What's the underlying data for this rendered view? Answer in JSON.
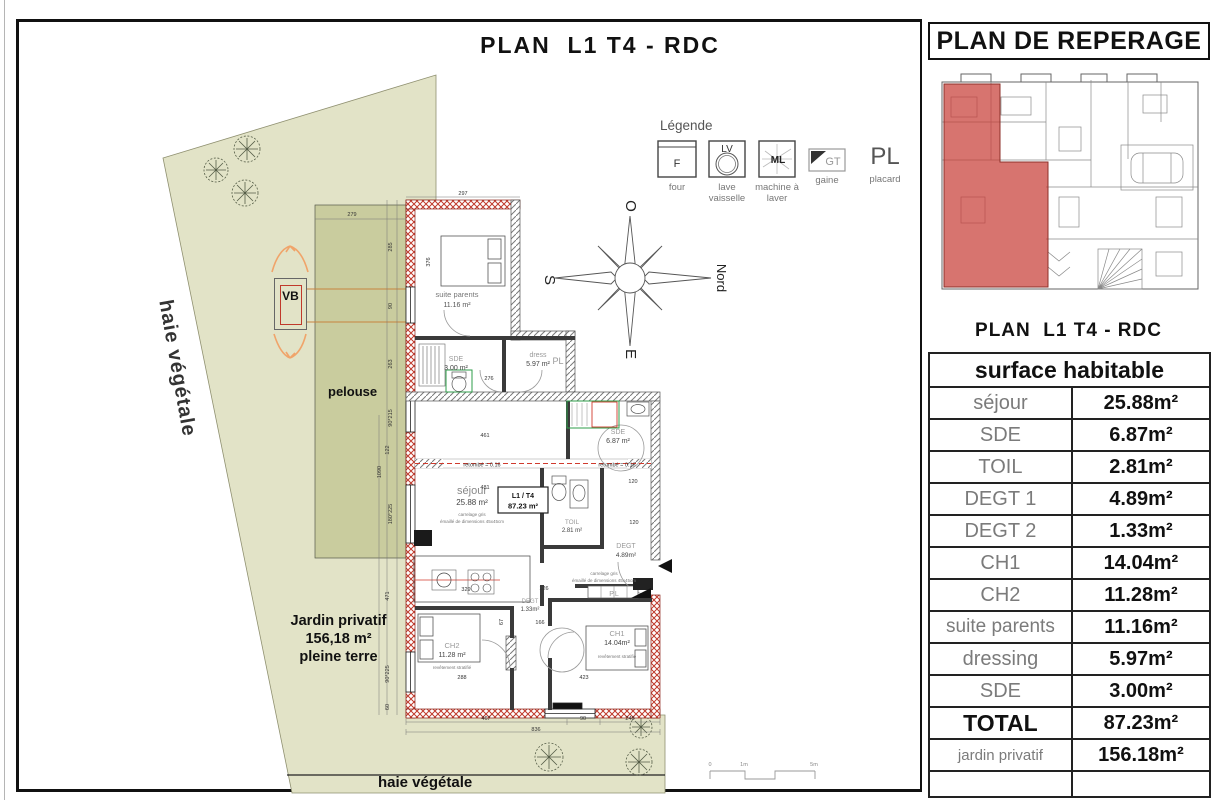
{
  "title": "PLAN  L1 T4 - RDC",
  "legend": {
    "title": "Légende",
    "items": [
      {
        "symbol": "F",
        "label": "four"
      },
      {
        "symbol": "LV",
        "label": "lave vaisselle"
      },
      {
        "symbol": "ML",
        "label": "machine à laver"
      },
      {
        "symbol": "GT",
        "label": "gaine"
      },
      {
        "symbol": "PL",
        "label": "placard"
      }
    ]
  },
  "compass": {
    "top": "O",
    "left": "S",
    "bottom": "E",
    "right": "Nord"
  },
  "site": {
    "hedge_left": "haie végétale",
    "hedge_bottom": "haie végétale",
    "lawn": "pelouse",
    "vb": "VB",
    "garden_line1": "Jardin privatif",
    "garden_line2": "156,18 m²",
    "garden_line3": "pleine terre"
  },
  "plan": {
    "rooms": {
      "suite_parents": {
        "name": "suite parents",
        "area": "11.16 m²"
      },
      "sde_suite": {
        "name": "SDE",
        "area": "3.00 m²"
      },
      "dress": {
        "name": "dress",
        "area": "5.97 m²",
        "pl": "PL"
      },
      "sejour": {
        "name": "séjour",
        "area": "25.88 m²",
        "note1": "carrelage gris",
        "note2": "émaillé de dimensions 45x45cm"
      },
      "unit": {
        "line1": "L1 / T4",
        "line2": "87.23 m²"
      },
      "sde": {
        "name": "SDE",
        "area": "6.87 m²"
      },
      "toil": {
        "name": "TOIL",
        "area": "2.81 m²"
      },
      "degt1": {
        "name": "DEGT",
        "area": "4.89m²"
      },
      "degt2": {
        "name": "DEGT",
        "area": "1.33m²"
      },
      "pl": "P.L",
      "ch2": {
        "name": "CH2",
        "area": "11.28 m²",
        "note": "revêtement stratifié"
      },
      "ch1": {
        "name": "CH1",
        "area": "14.04m²",
        "note": "revêtement stratifié"
      }
    },
    "notes": {
      "beam_left": "retombé = 0.16",
      "beam_right": "retombé = 0.16",
      "hall_note1": "carrelage gris",
      "hall_note2": "émaillé de dimensions 45x45cm"
    },
    "dims": [
      "297",
      "376",
      "276",
      "461",
      "481",
      "120",
      "120",
      "329",
      "126",
      "166",
      "288",
      "423",
      "467",
      "90",
      "248",
      "836",
      "279",
      "285",
      "90",
      "263",
      "90*215",
      "122",
      "1090",
      "180*225",
      "471",
      "90*225",
      "60",
      "67"
    ],
    "scalebar": {
      "zero": "0",
      "one": "1m",
      "five": "5m"
    }
  },
  "panel": {
    "title": "PLAN DE REPERAGE",
    "plan_caption": "PLAN  L1 T4 - RDC",
    "table_header": "surface habitable",
    "rows": [
      {
        "label": "séjour",
        "value": "25.88m²"
      },
      {
        "label": "SDE",
        "value": "6.87m²"
      },
      {
        "label": "TOIL",
        "value": "2.81m²"
      },
      {
        "label": "DEGT 1",
        "value": "4.89m²"
      },
      {
        "label": "DEGT 2",
        "value": "1.33m²"
      },
      {
        "label": "CH1",
        "value": "14.04m²"
      },
      {
        "label": "CH2",
        "value": "11.28m²"
      },
      {
        "label": "suite parents",
        "value": "11.16m²"
      },
      {
        "label": "dressing",
        "value": "5.97m²"
      },
      {
        "label": "SDE",
        "value": "3.00m²"
      },
      {
        "label": "TOTAL",
        "value": "87.23m²"
      },
      {
        "label": "jardin privatif",
        "value": "156.18m²"
      }
    ]
  },
  "colors": {
    "wall_red": "#c0392b",
    "highlight_red": "#cd5a52",
    "garden": "#e2e3c7",
    "lawn": "#c9cc9e",
    "label_gray": "#7b7b7b",
    "fixture_green": "#2e9e49",
    "arrow_orange": "#f0a46a"
  }
}
